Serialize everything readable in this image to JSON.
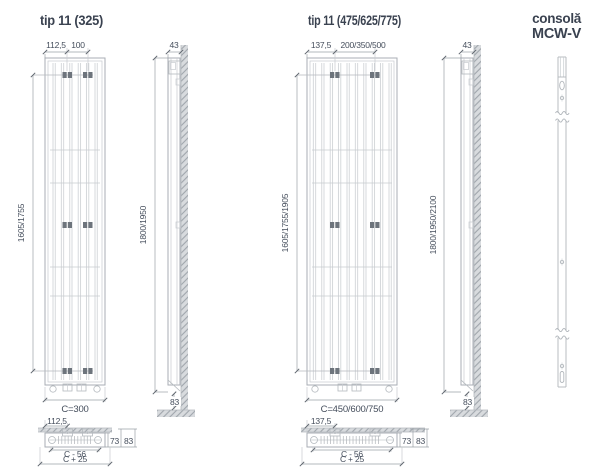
{
  "left": {
    "title": "tip 11 (325)",
    "front": {
      "dim_top_offset": "112,5",
      "dim_top_span": "100",
      "dim_height_inner": "1605/1755",
      "dim_width": "C=300"
    },
    "side": {
      "dim_depth": "43",
      "dim_height_total": "1800/1950",
      "dim_floor_gap": "83"
    },
    "plan": {
      "dim_offset": "112,5",
      "dim_depth_inner": "73",
      "dim_depth_outer": "83",
      "dim_c_minus": "C - 56",
      "dim_c_plus": "C + 25"
    }
  },
  "middle": {
    "title": "tip 11 (475/625/775)",
    "front": {
      "dim_top_offset": "137,5",
      "dim_top_span": "200/350/500",
      "dim_height_inner": "1605/1755/1905",
      "dim_width": "C=450/600/750"
    },
    "side": {
      "dim_depth": "43",
      "dim_height_total": "1800/1950/2100",
      "dim_floor_gap": "83"
    },
    "plan": {
      "dim_offset": "137,5",
      "dim_depth_inner": "73",
      "dim_depth_outer": "83",
      "dim_c_minus": "C - 56",
      "dim_c_plus": "C + 25"
    }
  },
  "console": {
    "title_line1": "consolă",
    "title_line2": "MCW-V"
  },
  "colors": {
    "text": "#454e5c",
    "title_text": "#3a4250",
    "drawing_line": "#a9aeb4",
    "hatch_fill": "#d8dbde",
    "clamp": "#6d747c"
  }
}
